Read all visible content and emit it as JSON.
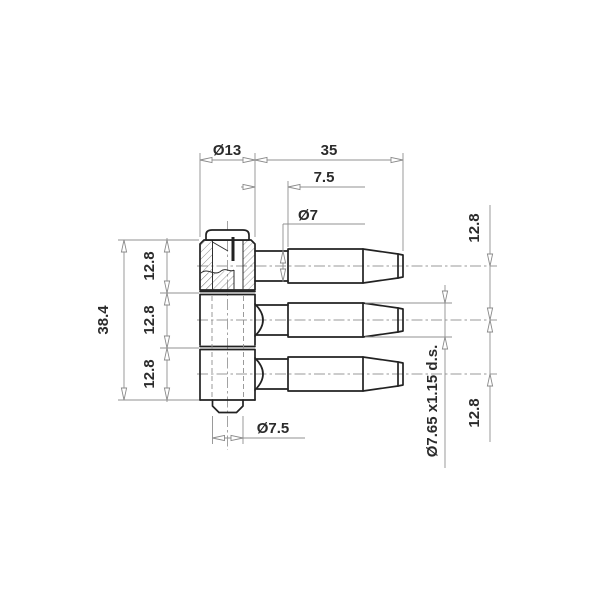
{
  "drawing": {
    "dimensions": {
      "cap_od": "Ø13",
      "pin_length": "35",
      "neck_length": "7.5",
      "neck_od": "Ø7",
      "body_length": "38.4",
      "left_segments": [
        "12.8",
        "12.8",
        "12.8"
      ],
      "right_spacing_top": "12.8",
      "right_spacing_bottom": "12.8",
      "thread_spec": "Ø7.65 x1.15 d.s.",
      "bottom_stub_od": "Ø7.5"
    },
    "colors": {
      "background": "#ffffff",
      "part_line": "#222222",
      "dimension_line": "#909090",
      "text": "#2b2b2b"
    }
  }
}
